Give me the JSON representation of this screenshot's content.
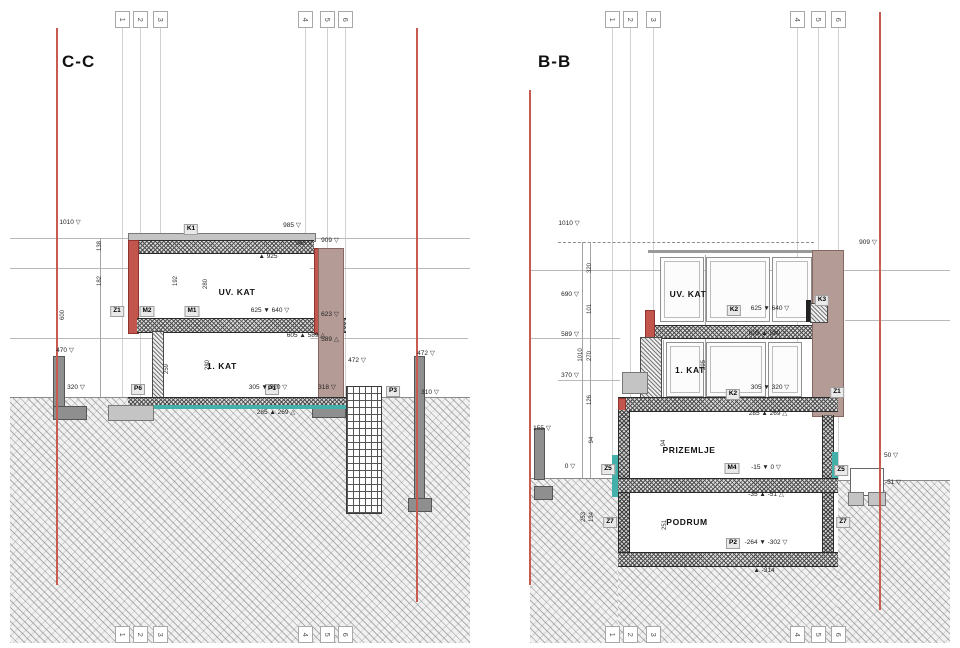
{
  "drawing": {
    "type": "architectural cross sections",
    "left_section_title": "C-C",
    "right_section_title": "B-B"
  },
  "grid": {
    "numbers": [
      "1",
      "2",
      "3",
      "4",
      "5",
      "6"
    ]
  },
  "colors": {
    "section_cut_red": "#c75b51",
    "waterproofing_teal": "#43b0a9",
    "neighbour_wall_brown": "#b49b95",
    "brick_wall_red": "#c2564e"
  },
  "annotations": [
    {
      "panel": "C-C",
      "type": "chip",
      "text": "K1",
      "x": 191,
      "y": 224
    },
    {
      "panel": "C-C",
      "type": "chip",
      "text": "Z1",
      "x": 117,
      "y": 306
    },
    {
      "panel": "C-C",
      "type": "chip",
      "text": "M2",
      "x": 147,
      "y": 306
    },
    {
      "panel": "C-C",
      "type": "chip",
      "text": "M1",
      "x": 192,
      "y": 306
    },
    {
      "panel": "C-C",
      "type": "chip",
      "text": "P6",
      "x": 138,
      "y": 384
    },
    {
      "panel": "C-C",
      "type": "chip",
      "text": "P1",
      "x": 272,
      "y": 384
    },
    {
      "panel": "C-C",
      "type": "chip",
      "text": "P3",
      "x": 393,
      "y": 386
    },
    {
      "panel": "C-C",
      "type": "room",
      "text": "UV. KAT",
      "x": 237,
      "y": 288
    },
    {
      "panel": "C-C",
      "type": "room",
      "text": "1. KAT",
      "x": 222,
      "y": 362
    },
    {
      "panel": "C-C",
      "type": "level",
      "text": "1010 ▽",
      "x": 70,
      "y": 220
    },
    {
      "panel": "C-C",
      "type": "level",
      "text": "985 ▽",
      "x": 292,
      "y": 223
    },
    {
      "panel": "C-C",
      "type": "level",
      "text": "948 ▽",
      "x": 304,
      "y": 241
    },
    {
      "panel": "C-C",
      "type": "level",
      "text": "▲ 925",
      "x": 268,
      "y": 254
    },
    {
      "panel": "C-C",
      "type": "level",
      "text": "909 ▽",
      "x": 330,
      "y": 238
    },
    {
      "panel": "C-C",
      "type": "level",
      "text": "623 ▽",
      "x": 330,
      "y": 312
    },
    {
      "panel": "C-C",
      "type": "level",
      "text": "589 △",
      "x": 330,
      "y": 337
    },
    {
      "panel": "C-C",
      "type": "level",
      "text": "625 ▼ 640 ▽",
      "x": 270,
      "y": 308
    },
    {
      "panel": "C-C",
      "type": "level",
      "text": "605 ▲ 589 △",
      "x": 306,
      "y": 333
    },
    {
      "panel": "C-C",
      "type": "level",
      "text": "305 ▼ 320 ▽",
      "x": 268,
      "y": 385
    },
    {
      "panel": "C-C",
      "type": "level",
      "text": "285 ▲ 269 △",
      "x": 276,
      "y": 410
    },
    {
      "panel": "C-C",
      "type": "level",
      "text": "318 ▽",
      "x": 327,
      "y": 385
    },
    {
      "panel": "C-C",
      "type": "level",
      "text": "320 ▽",
      "x": 76,
      "y": 385
    },
    {
      "panel": "C-C",
      "type": "level",
      "text": "470 ▽",
      "x": 65,
      "y": 348
    },
    {
      "panel": "C-C",
      "type": "level",
      "text": "472 ▽",
      "x": 357,
      "y": 358
    },
    {
      "panel": "C-C",
      "type": "level",
      "text": "472 ▽",
      "x": 426,
      "y": 351
    },
    {
      "panel": "C-C",
      "type": "level",
      "text": "310 ▽",
      "x": 430,
      "y": 390
    },
    {
      "panel": "C-C",
      "type": "dim",
      "text": "138",
      "x": 100,
      "y": 243
    },
    {
      "panel": "C-C",
      "type": "dim",
      "text": "182",
      "x": 100,
      "y": 278
    },
    {
      "panel": "C-C",
      "type": "dim",
      "text": "600",
      "x": 63,
      "y": 312
    },
    {
      "panel": "C-C",
      "type": "dim",
      "text": "192",
      "x": 176,
      "y": 278
    },
    {
      "panel": "C-C",
      "type": "dim",
      "text": "280",
      "x": 206,
      "y": 281
    },
    {
      "panel": "C-C",
      "type": "dim",
      "text": "259",
      "x": 167,
      "y": 366
    },
    {
      "panel": "C-C",
      "type": "dim",
      "text": "280",
      "x": 208,
      "y": 362
    },
    {
      "panel": "B-B",
      "type": "chip",
      "text": "K2",
      "x": 734,
      "y": 305
    },
    {
      "panel": "B-B",
      "type": "chip",
      "text": "K3",
      "x": 822,
      "y": 295
    },
    {
      "panel": "B-B",
      "type": "chip",
      "text": "K2",
      "x": 733,
      "y": 389
    },
    {
      "panel": "B-B",
      "type": "chip",
      "text": "Z1",
      "x": 837,
      "y": 387
    },
    {
      "panel": "B-B",
      "type": "chip",
      "text": "Z5",
      "x": 608,
      "y": 464
    },
    {
      "panel": "B-B",
      "type": "chip",
      "text": "Z5",
      "x": 841,
      "y": 465
    },
    {
      "panel": "B-B",
      "type": "chip",
      "text": "Z7",
      "x": 610,
      "y": 517
    },
    {
      "panel": "B-B",
      "type": "chip",
      "text": "Z7",
      "x": 843,
      "y": 517
    },
    {
      "panel": "B-B",
      "type": "chip",
      "text": "M4",
      "x": 732,
      "y": 463
    },
    {
      "panel": "B-B",
      "type": "chip",
      "text": "P2",
      "x": 733,
      "y": 538
    },
    {
      "panel": "B-B",
      "type": "room",
      "text": "UV. KAT",
      "x": 688,
      "y": 290
    },
    {
      "panel": "B-B",
      "type": "room",
      "text": "1. KAT",
      "x": 690,
      "y": 366
    },
    {
      "panel": "B-B",
      "type": "room",
      "text": "PRIZEMLJE",
      "x": 689,
      "y": 446
    },
    {
      "panel": "B-B",
      "type": "room",
      "text": "PODRUM",
      "x": 687,
      "y": 518
    },
    {
      "panel": "B-B",
      "type": "level",
      "text": "1010 ▽",
      "x": 569,
      "y": 221
    },
    {
      "panel": "B-B",
      "type": "level",
      "text": "690 ▽",
      "x": 570,
      "y": 292
    },
    {
      "panel": "B-B",
      "type": "level",
      "text": "589 ▽",
      "x": 570,
      "y": 332
    },
    {
      "panel": "B-B",
      "type": "level",
      "text": "370 ▽",
      "x": 570,
      "y": 373
    },
    {
      "panel": "B-B",
      "type": "level",
      "text": "155 ▽",
      "x": 542,
      "y": 426
    },
    {
      "panel": "B-B",
      "type": "level",
      "text": "0 ▽",
      "x": 570,
      "y": 464
    },
    {
      "panel": "B-B",
      "type": "level",
      "text": "909 ▽",
      "x": 868,
      "y": 240
    },
    {
      "panel": "B-B",
      "type": "level",
      "text": "625 ▼ 640 ▽",
      "x": 770,
      "y": 306
    },
    {
      "panel": "B-B",
      "type": "level",
      "text": "605 ▲ 589 △",
      "x": 768,
      "y": 331
    },
    {
      "panel": "B-B",
      "type": "level",
      "text": "305 ▼ 320 ▽",
      "x": 770,
      "y": 385
    },
    {
      "panel": "B-B",
      "type": "level",
      "text": "285 ▲ 269 △",
      "x": 768,
      "y": 411
    },
    {
      "panel": "B-B",
      "type": "level",
      "text": "-15 ▼ 0 ▽",
      "x": 766,
      "y": 465
    },
    {
      "panel": "B-B",
      "type": "level",
      "text": "-35 ▲ -51 △",
      "x": 766,
      "y": 492
    },
    {
      "panel": "B-B",
      "type": "level",
      "text": "-264 ▼ -302 ▽",
      "x": 766,
      "y": 540
    },
    {
      "panel": "B-B",
      "type": "level",
      "text": "▲ -314",
      "x": 764,
      "y": 568
    },
    {
      "panel": "B-B",
      "type": "level",
      "text": "50 ▽",
      "x": 891,
      "y": 453
    },
    {
      "panel": "B-B",
      "type": "level",
      "text": "-51 ▽",
      "x": 893,
      "y": 480
    },
    {
      "panel": "B-B",
      "type": "dim",
      "text": "320",
      "x": 590,
      "y": 265
    },
    {
      "panel": "B-B",
      "type": "dim",
      "text": "101",
      "x": 590,
      "y": 306
    },
    {
      "panel": "B-B",
      "type": "dim",
      "text": "1010",
      "x": 581,
      "y": 352
    },
    {
      "panel": "B-B",
      "type": "dim",
      "text": "270",
      "x": 590,
      "y": 353
    },
    {
      "panel": "B-B",
      "type": "dim",
      "text": "126",
      "x": 590,
      "y": 397
    },
    {
      "panel": "B-B",
      "type": "dim",
      "text": "94",
      "x": 592,
      "y": 437
    },
    {
      "panel": "B-B",
      "type": "dim",
      "text": "253",
      "x": 584,
      "y": 514
    },
    {
      "panel": "B-B",
      "type": "dim",
      "text": "134",
      "x": 592,
      "y": 514
    },
    {
      "panel": "B-B",
      "type": "dim",
      "text": "295",
      "x": 704,
      "y": 362
    },
    {
      "panel": "B-B",
      "type": "dim",
      "text": "94",
      "x": 664,
      "y": 440
    },
    {
      "panel": "B-B",
      "type": "dim",
      "text": "251",
      "x": 665,
      "y": 522
    }
  ]
}
